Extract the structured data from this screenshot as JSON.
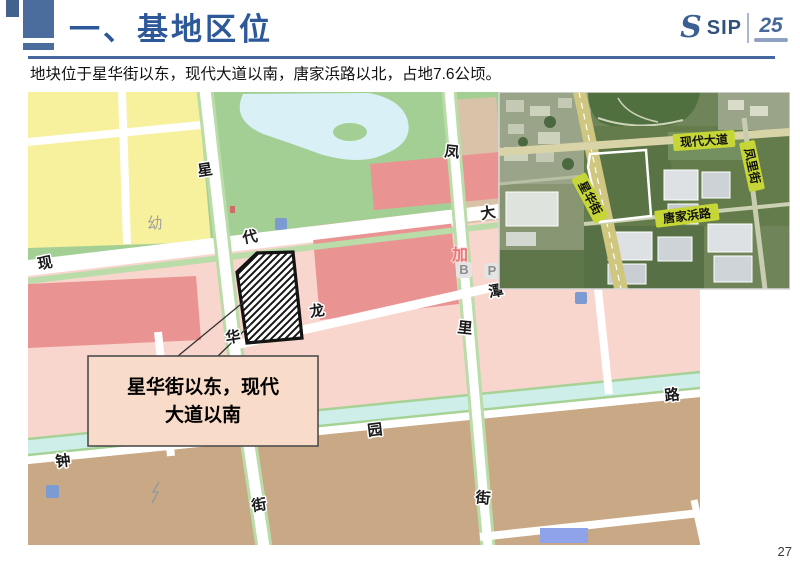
{
  "page": {
    "title": "一、基地区位",
    "subtitle": "地块位于星华街以东，现代大道以南，唐家浜路以北，占地7.6公顷。",
    "page_number": "27"
  },
  "logo": {
    "mark": "S",
    "sip": "SIP",
    "anniversary": "25"
  },
  "palette": {
    "accent_blue": "#2d5899",
    "rule_blue": "#44679f",
    "zone_yellow": "#f7f09c",
    "zone_green": "#a3cf95",
    "zone_water": "#d8f0f6",
    "zone_red": "#ea9393",
    "zone_pink": "#f8d5cd",
    "zone_brown": "#c9a985",
    "zone_teal": "#cdeee9",
    "zone_tan": "#d8c3a8",
    "inset_label_bg": "#c6d636"
  },
  "map": {
    "streets": {
      "xinghua_jie": [
        "星",
        "华",
        "街"
      ],
      "xiandai_dadao": [
        "现",
        "代",
        "大"
      ],
      "fengli_jie": [
        "凤",
        "里",
        "街"
      ],
      "zhongyuan_lu": [
        "钟",
        "园",
        "路"
      ],
      "longtan": [
        "龙",
        "潭"
      ]
    },
    "poi": {
      "kindergarten": "幼",
      "gas": "加",
      "b": "B",
      "p": "P"
    },
    "callout": {
      "line1": "星华街以东，现代",
      "line2": "大道以南"
    }
  },
  "inset": {
    "roads": {
      "xiandai_dadao": "现代大道",
      "fengli_jie": "凤里街",
      "xinghua_jie": "星华街",
      "tangjiabang_lu": "唐家浜路"
    }
  }
}
